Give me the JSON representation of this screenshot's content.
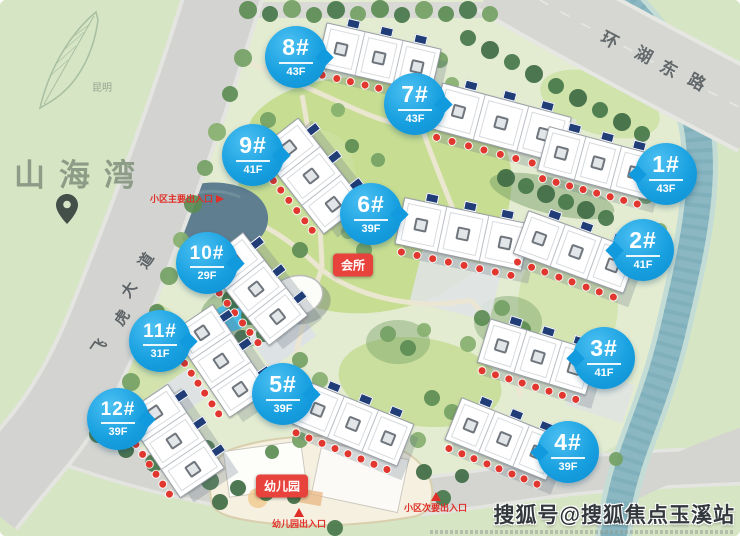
{
  "project": {
    "name": "山海湾",
    "city": "昆明"
  },
  "roads": {
    "east": "环湖东路",
    "west": "飞虎大道"
  },
  "buildings": [
    {
      "id": "1",
      "label": "1#",
      "floors": "43F"
    },
    {
      "id": "2",
      "label": "2#",
      "floors": "41F"
    },
    {
      "id": "3",
      "label": "3#",
      "floors": "41F"
    },
    {
      "id": "4",
      "label": "4#",
      "floors": "39F"
    },
    {
      "id": "5",
      "label": "5#",
      "floors": "39F"
    },
    {
      "id": "6",
      "label": "6#",
      "floors": "39F"
    },
    {
      "id": "7",
      "label": "7#",
      "floors": "43F"
    },
    {
      "id": "8",
      "label": "8#",
      "floors": "43F"
    },
    {
      "id": "9",
      "label": "9#",
      "floors": "41F"
    },
    {
      "id": "10",
      "label": "10#",
      "floors": "29F"
    },
    {
      "id": "11",
      "label": "11#",
      "floors": "31F"
    },
    {
      "id": "12",
      "label": "12#",
      "floors": "39F"
    }
  ],
  "amenities": {
    "clubhouse": "会所",
    "kindergarten": "幼儿园"
  },
  "entrances": {
    "main": "小区主要出入口",
    "secondary": "小区次要出入口",
    "kindergarten": "幼儿园出入口"
  },
  "watermark": "搜狐号@搜狐焦点玉溪站",
  "colors": {
    "badge_blue": "#18a0e0",
    "label_red": "#e23a32",
    "road_gray": "#d4d5d1",
    "river_teal": "#8ab7c0",
    "chip_navy": "#203d77"
  }
}
